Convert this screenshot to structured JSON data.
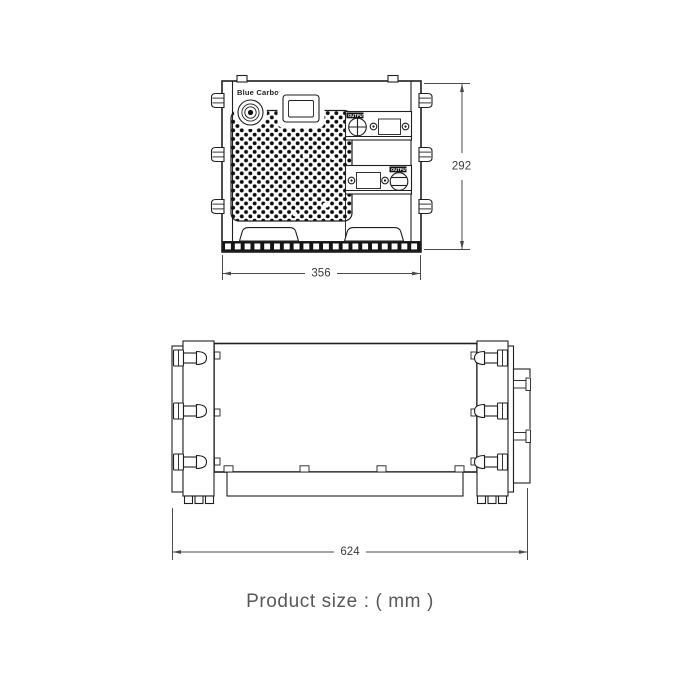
{
  "caption": {
    "text": "Product size :  ( mm )"
  },
  "front_view": {
    "brand": "Blue Carbon",
    "output_label_upper": "OUTPUT",
    "output_label_lower": "OUTPUT",
    "dim_height_mm": "292",
    "dim_width_mm": "356"
  },
  "side_view": {
    "dim_length_mm": "624"
  },
  "colors": {
    "line": "#1f1f1f",
    "dim_line": "#4a4a4a",
    "dim_text": "#3a3a3a",
    "caption_text": "#58585a",
    "mesh_dot": "#0d0d0d"
  }
}
